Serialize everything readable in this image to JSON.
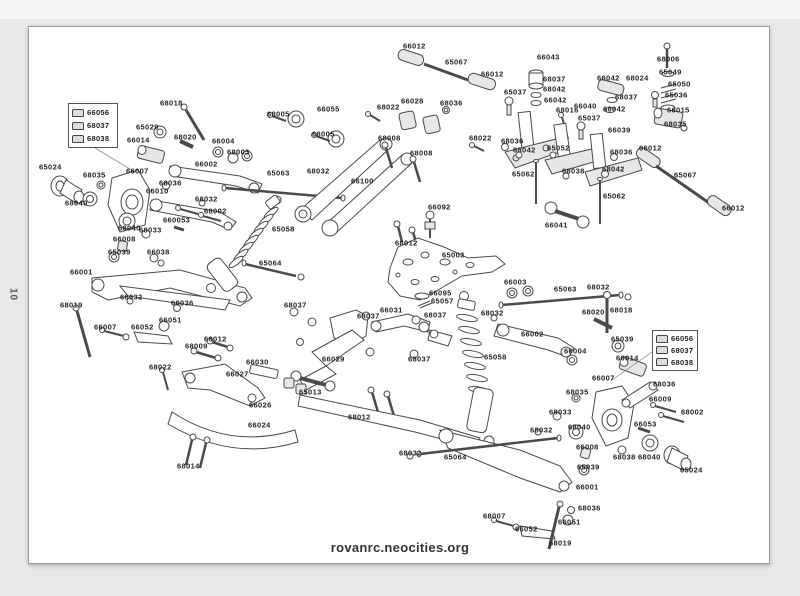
{
  "page": {
    "number": "10",
    "website": "rovanrc.neocities.org"
  },
  "diagram": {
    "legend_boxes": [
      {
        "x": 68,
        "y": 103,
        "w": 50,
        "h": 45,
        "items": [
          {
            "icon": "body-clip-large-icon",
            "label": "66056"
          },
          {
            "icon": "body-clip-medium-icon",
            "label": "68037"
          },
          {
            "icon": "body-clip-small-icon",
            "label": "68038"
          }
        ]
      },
      {
        "x": 652,
        "y": 330,
        "w": 46,
        "h": 41,
        "items": [
          {
            "icon": "body-clip-large-icon",
            "label": "66056"
          },
          {
            "icon": "body-clip-medium-icon",
            "label": "68037"
          },
          {
            "icon": "body-clip-small-icon",
            "label": "68038"
          }
        ]
      }
    ],
    "labels": [
      {
        "t": "66012",
        "x": 403,
        "y": 46
      },
      {
        "t": "65067",
        "x": 445,
        "y": 62
      },
      {
        "t": "66012",
        "x": 481,
        "y": 74
      },
      {
        "t": "66043",
        "x": 537,
        "y": 57
      },
      {
        "t": "68037",
        "x": 543,
        "y": 79
      },
      {
        "t": "68042",
        "x": 543,
        "y": 89
      },
      {
        "t": "66042",
        "x": 544,
        "y": 100
      },
      {
        "t": "65037",
        "x": 504,
        "y": 92
      },
      {
        "t": "68016",
        "x": 556,
        "y": 110
      },
      {
        "t": "66040",
        "x": 574,
        "y": 106
      },
      {
        "t": "65037",
        "x": 578,
        "y": 118
      },
      {
        "t": "66039",
        "x": 608,
        "y": 130
      },
      {
        "t": "68036",
        "x": 501,
        "y": 141
      },
      {
        "t": "68042",
        "x": 513,
        "y": 150
      },
      {
        "t": "65052",
        "x": 547,
        "y": 148
      },
      {
        "t": "68036",
        "x": 610,
        "y": 152
      },
      {
        "t": "68038",
        "x": 562,
        "y": 171
      },
      {
        "t": "68042",
        "x": 602,
        "y": 169
      },
      {
        "t": "65062",
        "x": 512,
        "y": 174
      },
      {
        "t": "65062",
        "x": 603,
        "y": 196
      },
      {
        "t": "66041",
        "x": 545,
        "y": 225
      },
      {
        "t": "66042",
        "x": 597,
        "y": 78
      },
      {
        "t": "68037",
        "x": 615,
        "y": 97
      },
      {
        "t": "68042",
        "x": 603,
        "y": 109
      },
      {
        "t": "68024",
        "x": 626,
        "y": 78
      },
      {
        "t": "68006",
        "x": 657,
        "y": 59
      },
      {
        "t": "65049",
        "x": 659,
        "y": 72
      },
      {
        "t": "65050",
        "x": 668,
        "y": 84
      },
      {
        "t": "65036",
        "x": 665,
        "y": 95
      },
      {
        "t": "66015",
        "x": 667,
        "y": 110
      },
      {
        "t": "68035",
        "x": 664,
        "y": 124
      },
      {
        "t": "66012",
        "x": 639,
        "y": 148
      },
      {
        "t": "65067",
        "x": 674,
        "y": 175
      },
      {
        "t": "66012",
        "x": 722,
        "y": 208
      },
      {
        "t": "68018",
        "x": 160,
        "y": 103
      },
      {
        "t": "65029",
        "x": 136,
        "y": 127
      },
      {
        "t": "68020",
        "x": 174,
        "y": 137
      },
      {
        "t": "66014",
        "x": 127,
        "y": 140
      },
      {
        "t": "66004",
        "x": 212,
        "y": 141
      },
      {
        "t": "68003",
        "x": 227,
        "y": 152
      },
      {
        "t": "66002",
        "x": 195,
        "y": 164
      },
      {
        "t": "68005",
        "x": 267,
        "y": 114
      },
      {
        "t": "66055",
        "x": 317,
        "y": 109
      },
      {
        "t": "68005",
        "x": 312,
        "y": 134
      },
      {
        "t": "65024",
        "x": 39,
        "y": 167
      },
      {
        "t": "68035",
        "x": 83,
        "y": 175
      },
      {
        "t": "66007",
        "x": 126,
        "y": 171
      },
      {
        "t": "68036",
        "x": 159,
        "y": 183
      },
      {
        "t": "66010",
        "x": 146,
        "y": 191
      },
      {
        "t": "68032",
        "x": 195,
        "y": 199
      },
      {
        "t": "68040",
        "x": 65,
        "y": 203
      },
      {
        "t": "65063",
        "x": 267,
        "y": 173
      },
      {
        "t": "68040",
        "x": 118,
        "y": 228
      },
      {
        "t": "68033",
        "x": 139,
        "y": 230
      },
      {
        "t": "66008",
        "x": 113,
        "y": 239
      },
      {
        "t": "65039",
        "x": 108,
        "y": 252
      },
      {
        "t": "660053",
        "x": 163,
        "y": 220
      },
      {
        "t": "68002",
        "x": 204,
        "y": 211
      },
      {
        "t": "66038",
        "x": 147,
        "y": 252
      },
      {
        "t": "66001",
        "x": 70,
        "y": 272
      },
      {
        "t": "68032",
        "x": 120,
        "y": 297
      },
      {
        "t": "68019",
        "x": 60,
        "y": 305
      },
      {
        "t": "66007",
        "x": 94,
        "y": 327
      },
      {
        "t": "66052",
        "x": 131,
        "y": 327
      },
      {
        "t": "66051",
        "x": 159,
        "y": 320
      },
      {
        "t": "68036",
        "x": 171,
        "y": 303
      },
      {
        "t": "65058",
        "x": 272,
        "y": 229
      },
      {
        "t": "65064",
        "x": 259,
        "y": 263
      },
      {
        "t": "68022",
        "x": 377,
        "y": 107
      },
      {
        "t": "66028",
        "x": 401,
        "y": 101
      },
      {
        "t": "68036",
        "x": 440,
        "y": 103
      },
      {
        "t": "68008",
        "x": 378,
        "y": 138
      },
      {
        "t": "68008",
        "x": 410,
        "y": 153
      },
      {
        "t": "68022",
        "x": 469,
        "y": 138
      },
      {
        "t": "68032",
        "x": 307,
        "y": 171
      },
      {
        "t": "66100",
        "x": 351,
        "y": 181
      },
      {
        "t": "66092",
        "x": 428,
        "y": 207
      },
      {
        "t": "68012",
        "x": 395,
        "y": 243
      },
      {
        "t": "65003",
        "x": 442,
        "y": 255
      },
      {
        "t": "66095",
        "x": 429,
        "y": 293
      },
      {
        "t": "65057",
        "x": 431,
        "y": 301
      },
      {
        "t": "68037",
        "x": 284,
        "y": 305
      },
      {
        "t": "66031",
        "x": 380,
        "y": 310
      },
      {
        "t": "68037",
        "x": 357,
        "y": 316
      },
      {
        "t": "68037",
        "x": 424,
        "y": 315
      },
      {
        "t": "66029",
        "x": 322,
        "y": 359
      },
      {
        "t": "68037",
        "x": 408,
        "y": 359
      },
      {
        "t": "65013",
        "x": 299,
        "y": 392
      },
      {
        "t": "68012",
        "x": 348,
        "y": 417
      },
      {
        "t": "68022",
        "x": 149,
        "y": 367
      },
      {
        "t": "68009",
        "x": 185,
        "y": 346
      },
      {
        "t": "68012",
        "x": 204,
        "y": 339
      },
      {
        "t": "66030",
        "x": 246,
        "y": 362
      },
      {
        "t": "66027",
        "x": 226,
        "y": 374
      },
      {
        "t": "66026",
        "x": 249,
        "y": 405
      },
      {
        "t": "66024",
        "x": 248,
        "y": 425
      },
      {
        "t": "68014",
        "x": 177,
        "y": 466
      },
      {
        "t": "68032",
        "x": 399,
        "y": 453
      },
      {
        "t": "65064",
        "x": 444,
        "y": 457
      },
      {
        "t": "68032",
        "x": 481,
        "y": 313
      },
      {
        "t": "65058",
        "x": 484,
        "y": 357
      },
      {
        "t": "66003",
        "x": 504,
        "y": 282
      },
      {
        "t": "65063",
        "x": 554,
        "y": 289
      },
      {
        "t": "68032",
        "x": 587,
        "y": 287
      },
      {
        "t": "68020",
        "x": 582,
        "y": 312
      },
      {
        "t": "68018",
        "x": 610,
        "y": 310
      },
      {
        "t": "66002",
        "x": 521,
        "y": 334
      },
      {
        "t": "66004",
        "x": 564,
        "y": 351
      },
      {
        "t": "65039",
        "x": 611,
        "y": 339
      },
      {
        "t": "66014",
        "x": 616,
        "y": 358
      },
      {
        "t": "68035",
        "x": 566,
        "y": 392
      },
      {
        "t": "66007",
        "x": 592,
        "y": 378
      },
      {
        "t": "68036",
        "x": 653,
        "y": 384
      },
      {
        "t": "66009",
        "x": 649,
        "y": 399
      },
      {
        "t": "68002",
        "x": 681,
        "y": 412
      },
      {
        "t": "66053",
        "x": 634,
        "y": 424
      },
      {
        "t": "68038",
        "x": 613,
        "y": 457
      },
      {
        "t": "68040",
        "x": 638,
        "y": 457
      },
      {
        "t": "65024",
        "x": 680,
        "y": 470
      },
      {
        "t": "68033",
        "x": 549,
        "y": 412
      },
      {
        "t": "68040",
        "x": 568,
        "y": 427
      },
      {
        "t": "68032",
        "x": 530,
        "y": 430
      },
      {
        "t": "66008",
        "x": 576,
        "y": 447
      },
      {
        "t": "65039",
        "x": 577,
        "y": 467
      },
      {
        "t": "66001",
        "x": 576,
        "y": 487
      },
      {
        "t": "68036",
        "x": 578,
        "y": 508
      },
      {
        "t": "66051",
        "x": 558,
        "y": 522
      },
      {
        "t": "66052",
        "x": 515,
        "y": 529
      },
      {
        "t": "68007",
        "x": 483,
        "y": 516
      },
      {
        "t": "68019",
        "x": 549,
        "y": 543
      }
    ]
  }
}
